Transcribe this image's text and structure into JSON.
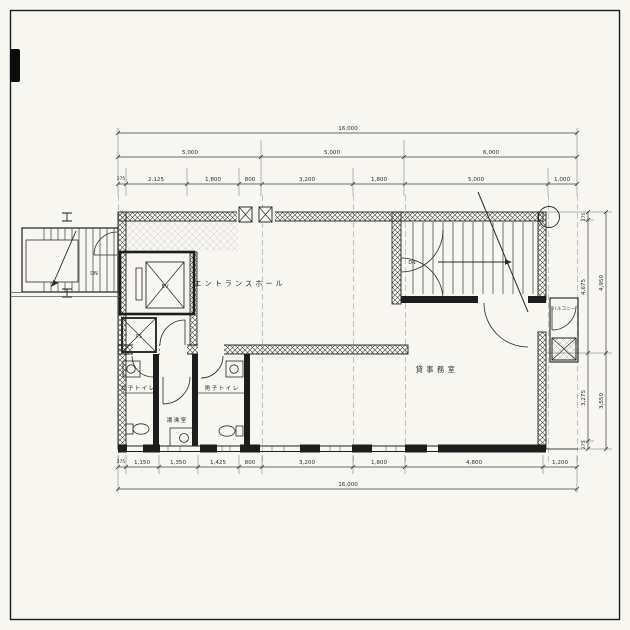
{
  "drawing": {
    "rooms": {
      "entrance_hall": "エントランスホール",
      "office": "貸事務室",
      "mens_toilet": "男子トイレ",
      "womens_toilet": "女子トイレ",
      "kitchenette": "湯沸室",
      "balcony": "バルコニー"
    },
    "marks": {
      "elevator": "EV",
      "pipe_shaft": "PS",
      "down_left": "DN",
      "down_right": "DN"
    },
    "dimensions": {
      "top_total": "16,000",
      "top_spans": [
        "5,000",
        "5,000",
        "6,000"
      ],
      "top_detail": [
        "275",
        "2,125",
        "1,800",
        "800",
        "3,200",
        "1,800",
        "5,000",
        "1,000"
      ],
      "bottom_detail": [
        "275",
        "1,150",
        "1,350",
        "1,425",
        "800",
        "3,200",
        "1,800",
        "4,800",
        "1,200"
      ],
      "bottom_total": "16,000",
      "right_inner": [
        "275",
        "4,675",
        "3,275",
        "275"
      ],
      "right_outer": [
        "4,950",
        "3,550"
      ]
    }
  }
}
